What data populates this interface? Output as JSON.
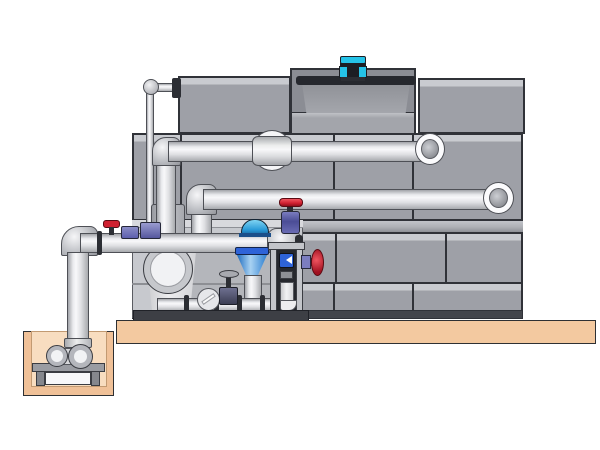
{
  "illustration": {
    "type": "technical-3d-illustration",
    "subject": "closed-circuit cooling tower with fan motor, external piping, pump skid and suction sump pit",
    "visible_text": "none"
  },
  "colors": {
    "bg": "#ffffff",
    "panel": "#9ea0a7",
    "panelLight": "#c9cbd0",
    "seam": "#303238",
    "recess": "#8b8d94",
    "bay": "#c7c9ce",
    "bayLower": "#b4b6bb",
    "bayDark": "#66686e",
    "pipeEdge": "#4e5056",
    "slab": "#f3c9a0",
    "basinInner": "#f8ddc0",
    "outline": "#2e3033",
    "motorCyan": "#25c3e8",
    "dark": "#1c1e24",
    "valveRed": "#cf2030",
    "valvePurple": "#5d5fae",
    "valveBlue": "#2e63d8",
    "coneBlue": "#3e9de4",
    "steel": "#c3c5ca",
    "white": "#f4f4f6"
  },
  "components": [
    "tower-casing-panels",
    "fan-recess",
    "fan-cowl",
    "fan-motor-cyan",
    "top-right-casing-box",
    "vent-line",
    "upper-return-pipe",
    "upper-pipe-wall-elbow",
    "mid-return-pipe",
    "mid-pipe-wall-elbow",
    "riser-pipes",
    "pipe-coupling-sleeve",
    "main-suction-pipe",
    "suction-elbow",
    "suction-drop-pipe",
    "sump-pit",
    "sump-pump",
    "concrete-slab",
    "pump-bay",
    "end-suction-pump",
    "isolation-valve-cluster",
    "butterfly-valve",
    "suction-diffuser-cone",
    "globe-valve-red-handwheel",
    "gate-valve",
    "check-valve",
    "control-stand-frame",
    "side-handwheel-valve",
    "skid-base"
  ]
}
